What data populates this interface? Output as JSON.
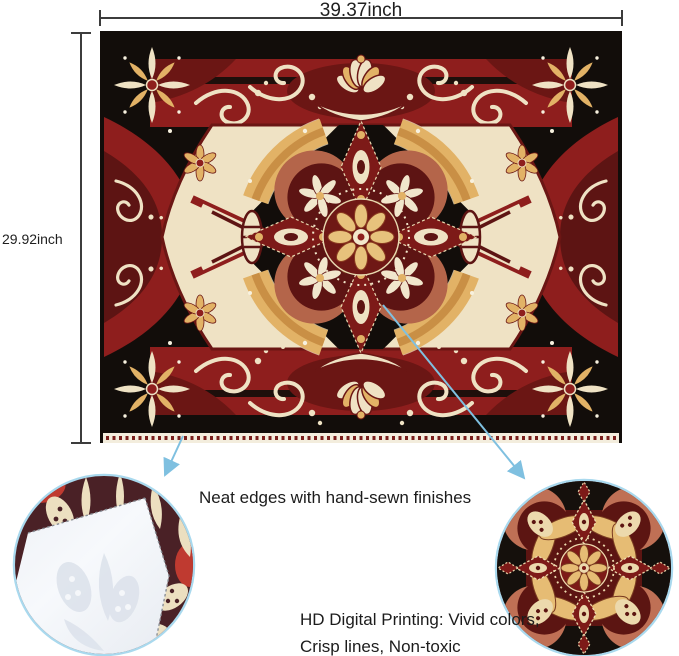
{
  "dimensions": {
    "width": "39.37inch",
    "height": "29.92inch"
  },
  "callouts": {
    "edge": "Neat edges with hand-sewn finishes",
    "print_line1": "HD Digital Printing: Vivid colors,",
    "print_line2": "Crisp lines, Non-toxic"
  },
  "colors": {
    "dimension_line": "#3c3c3c",
    "label_text": "#1f1f1f",
    "leader_blue": "#7fc0e0",
    "circle_rim": "#a9d9ee",
    "tapestry_black": "#120d0a",
    "tapestry_red": "#8e1e1d",
    "tapestry_maroon": "#5d1413",
    "tapestry_cream": "#efe2c4",
    "tapestry_gold": "#e2b266",
    "tapestry_terracotta": "#b4654a",
    "fabric_back_white": "#f5f7fa"
  },
  "figures": {
    "tapestry": "ornate-mandala-tapestry",
    "left_detail": "folded-corner-hand-sewn-edge",
    "right_detail": "mandala-print-closeup"
  }
}
